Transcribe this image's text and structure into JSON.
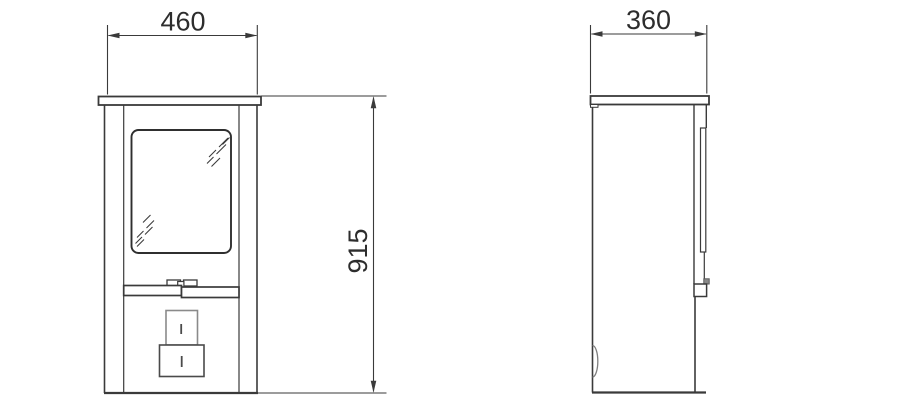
{
  "drawing": {
    "background_color": "#ffffff",
    "line_color": "#3a3a3a",
    "detail_line_color": "#7e7e7e",
    "text_color": "#2d2d2d",
    "views": {
      "front": {
        "width_dimension": "460",
        "height_dimension": "915"
      },
      "side": {
        "depth_dimension": "360"
      }
    }
  }
}
